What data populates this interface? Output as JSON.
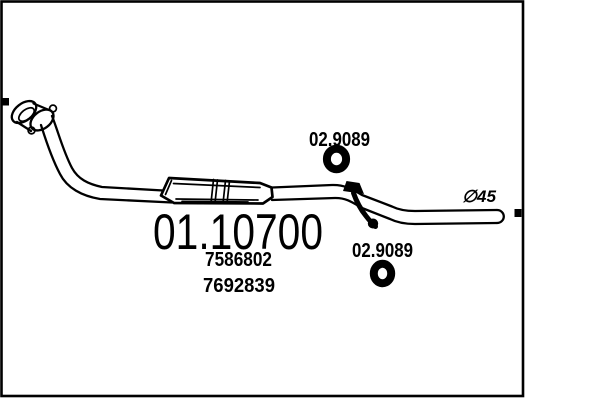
{
  "drawing": {
    "title": "exhaust-front-pipe-diagram",
    "main_part_number": "01.10700",
    "ref_numbers": [
      "7586802",
      "7692839"
    ],
    "gasket_labels": {
      "top": "02.9089",
      "bottom": "02.9089"
    },
    "diameter_label": "∅45",
    "colors": {
      "line": "#000000",
      "background": "#ffffff"
    }
  }
}
